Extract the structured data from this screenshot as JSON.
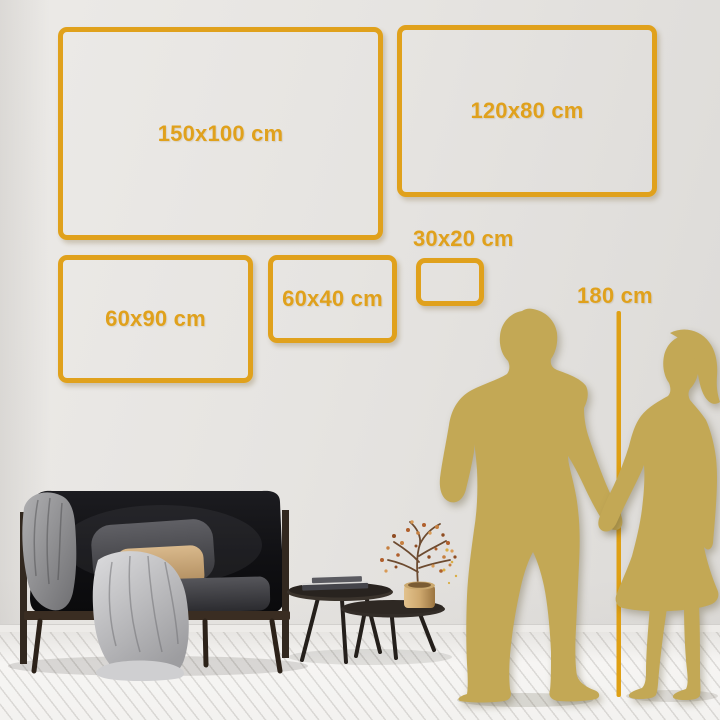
{
  "scene": {
    "title": "Wall art size comparison",
    "accent_color": "#E0A11C",
    "silhouette_color": "#C3A855",
    "unit": "cm"
  },
  "frames": [
    {
      "label": "150x100 cm"
    },
    {
      "label": "120x80 cm"
    },
    {
      "label": "60x90 cm"
    },
    {
      "label": "60x40 cm"
    },
    {
      "label": "30x20 cm"
    }
  ],
  "height_ruler": {
    "label": "180 cm"
  },
  "silhouettes": [
    {
      "name": "man holding hands"
    },
    {
      "name": "woman holding hands"
    }
  ],
  "furniture": {
    "sofa": "dark loveseat with wooden frame, gray blanket, light throw, gray and beige pillows",
    "tables": "two round nesting coffee tables with stacked books",
    "plant": "dried blossom branches in gold vase"
  }
}
